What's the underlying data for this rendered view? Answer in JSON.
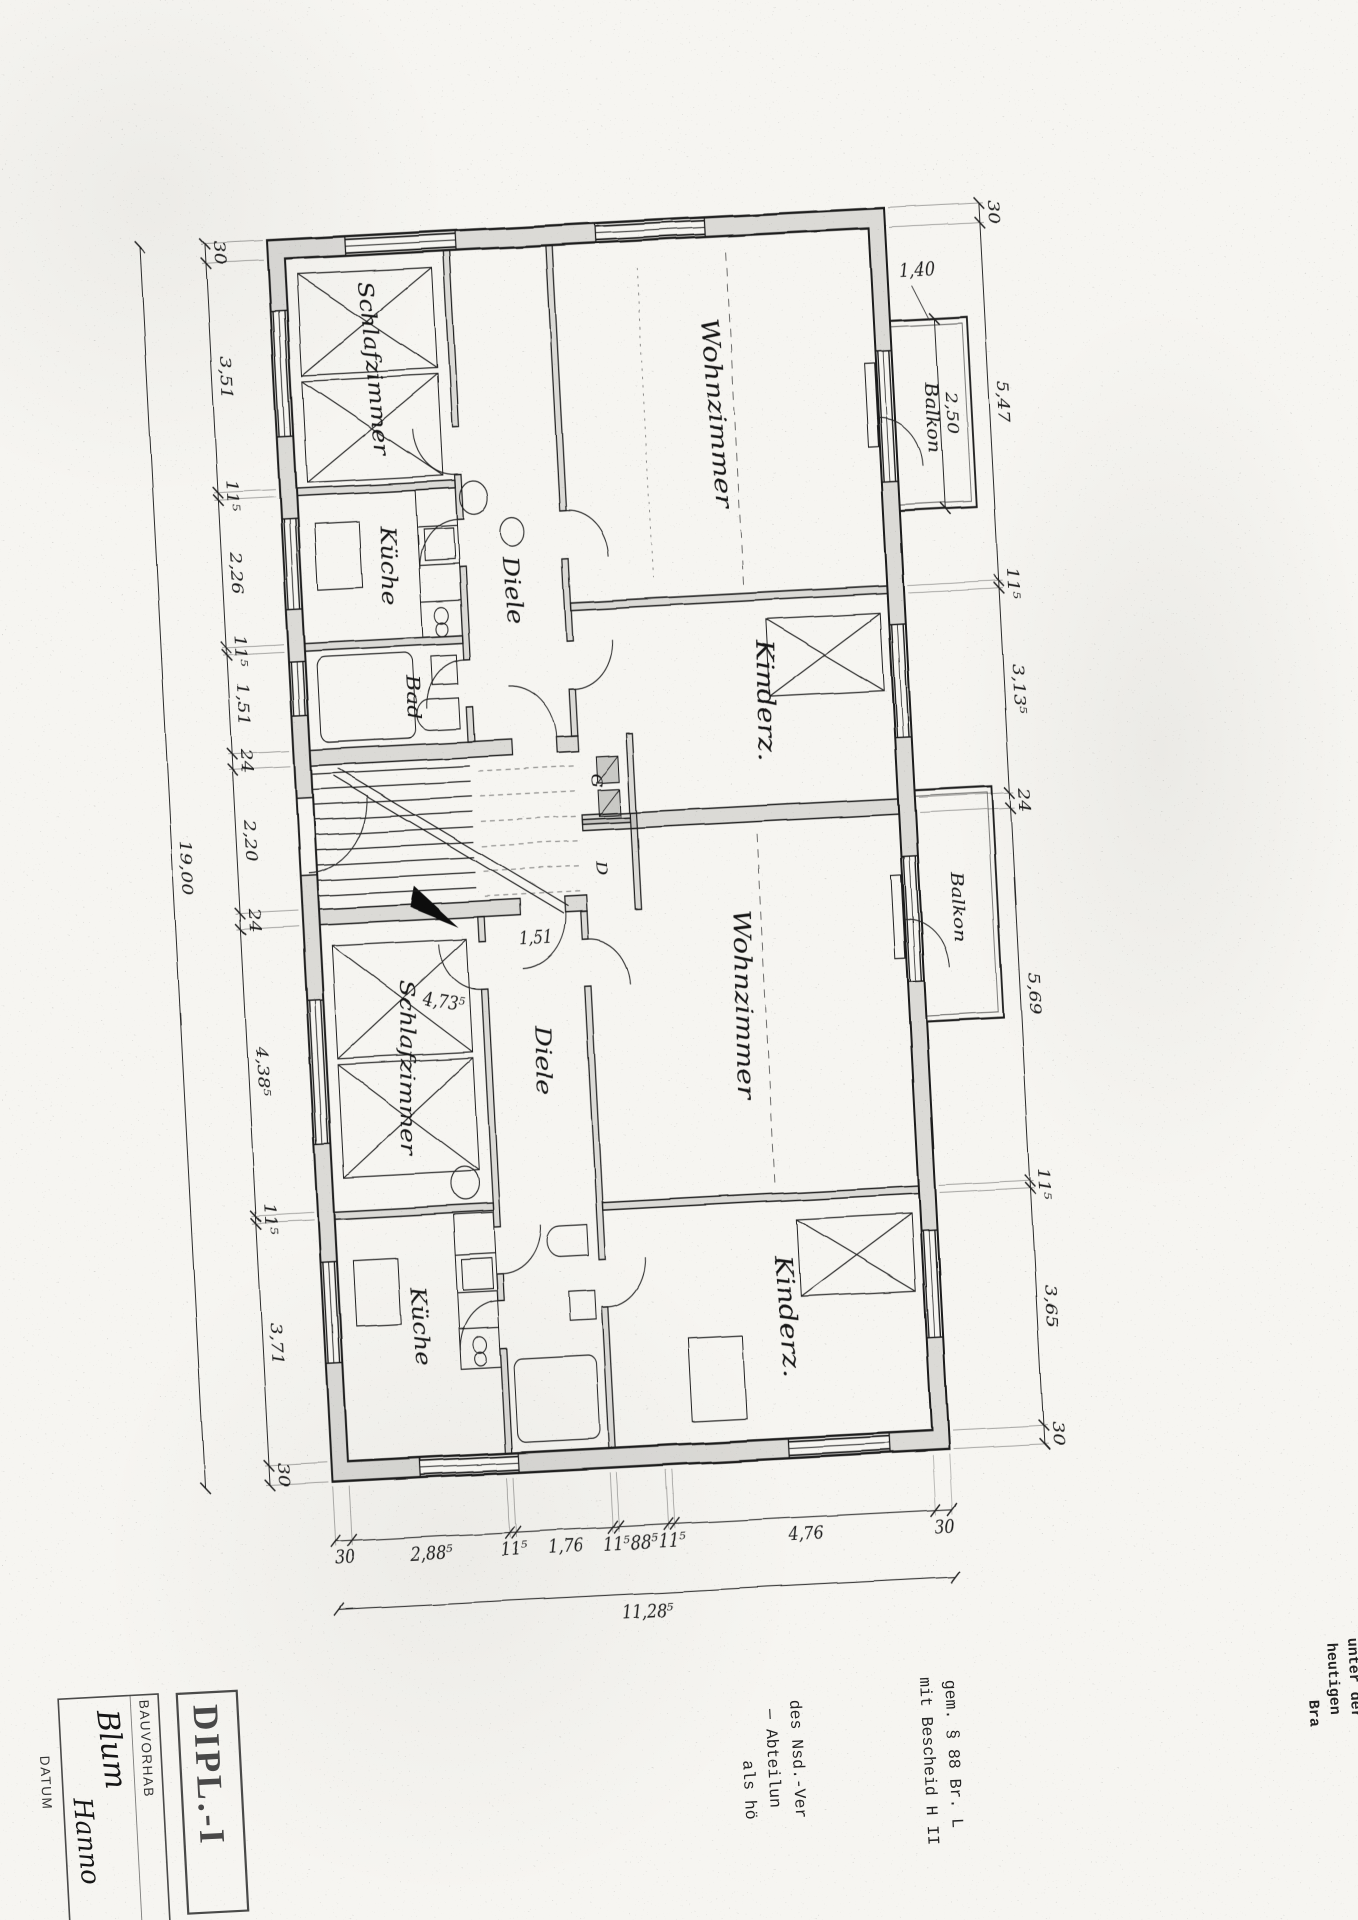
{
  "rooms": {
    "apartment1": {
      "wohnzimmer": "Wohnzimmer",
      "kinderzimmer": "Kinderz.",
      "schlafzimmer": "Schlafzimmer",
      "kueche": "Küche",
      "bad": "Bad",
      "diele": "Diele",
      "closet_g": "G",
      "closet_d": "D"
    },
    "apartment2": {
      "wohnzimmer": "Wohnzimmer",
      "kinderzimmer": "Kinderz.",
      "schlafzimmer": "Schlafzimmer",
      "kueche": "Küche",
      "diele": "Diele"
    },
    "balkon1": "Balkon",
    "balkon2": "Balkon"
  },
  "dims": {
    "bottom_chain": [
      "30",
      "3,51",
      "11⁵",
      "2,26",
      "11⁵",
      "1,51",
      "24",
      "2,20",
      "24",
      "4,38⁵",
      "11⁵",
      "3,71",
      "30"
    ],
    "bottom_total": "19,00",
    "top_chain": [
      "30",
      "5,47",
      "11⁵",
      "3,13⁵",
      "24",
      "5,69",
      "11⁵",
      "3,65",
      "30"
    ],
    "right_chain": [
      "30",
      "4,76",
      "11⁵",
      "88⁵",
      "11⁵",
      "1,76",
      "11⁵",
      "2,88⁵",
      "30"
    ],
    "right_total": "11,28⁵",
    "balcony_width": "2,50",
    "balcony_depth": "1,40",
    "diele_inner": "1,51",
    "schlafzimmer_inner": "4,73⁵"
  },
  "titleblock": {
    "stamp": "DIPL.-I",
    "project_label": "BAUVORHAB",
    "name_handwritten_1": "Blum",
    "name_handwritten_2": "Hanno",
    "date_label": "DATUM"
  },
  "legal": {
    "para1_line1": "gem. § 88 Br. L",
    "para1_line2": "mit Bescheid H II",
    "para2_line1": "des Nsd.-Ver",
    "para2_line2": "— Abteilun",
    "para2_line3": "als hö",
    "edge_line1": "unter der",
    "edge_line2": "heutigen",
    "edge_line3": "Bra"
  }
}
